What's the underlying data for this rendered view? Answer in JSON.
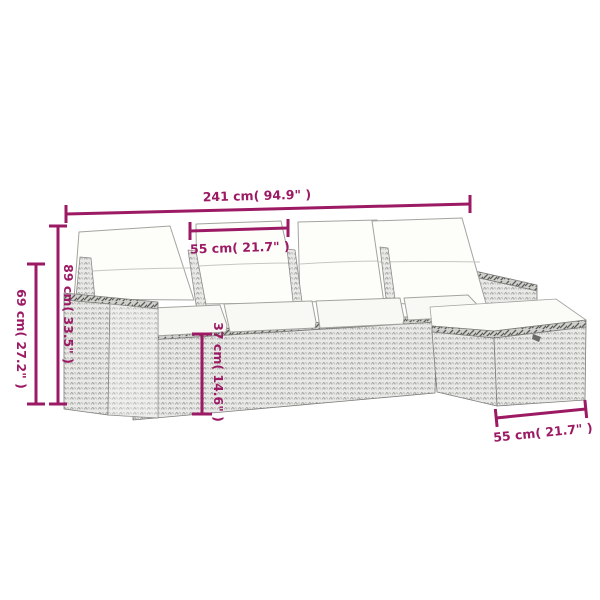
{
  "diagram": {
    "type": "product-dimension-diagram",
    "product": "5-piece poly rattan garden lounge set with cushions and ottoman",
    "colors": {
      "dimension_accent": "#9C1A64",
      "rattan_light": "#E9E9E7",
      "rattan_stitch": "#A6A6A3",
      "braid_dark": "#5B5B58",
      "cushion_white": "#FDFDFA",
      "outline_gray": "#8F8F8C",
      "background": "#FFFFFF"
    },
    "dimensions": {
      "total_width": {
        "label": "241 cm( 94.9\" )",
        "value_cm": 241,
        "value_inch": 94.9
      },
      "seat_width": {
        "label": "55 cm( 21.7\" )",
        "value_cm": 55,
        "value_inch": 21.7
      },
      "back_height": {
        "label": "89 cm( 33.5\" )",
        "value_cm": 89,
        "value_inch": 33.5
      },
      "armrest_height": {
        "label": "69 cm( 27.2\" )",
        "value_cm": 69,
        "value_inch": 27.2
      },
      "base_height": {
        "label": "37 cm( 14.6\" )",
        "value_cm": 37,
        "value_inch": 14.6
      },
      "ottoman_width": {
        "label": "55 cm( 21.7\" )",
        "value_cm": 55,
        "value_inch": 21.7
      }
    }
  }
}
